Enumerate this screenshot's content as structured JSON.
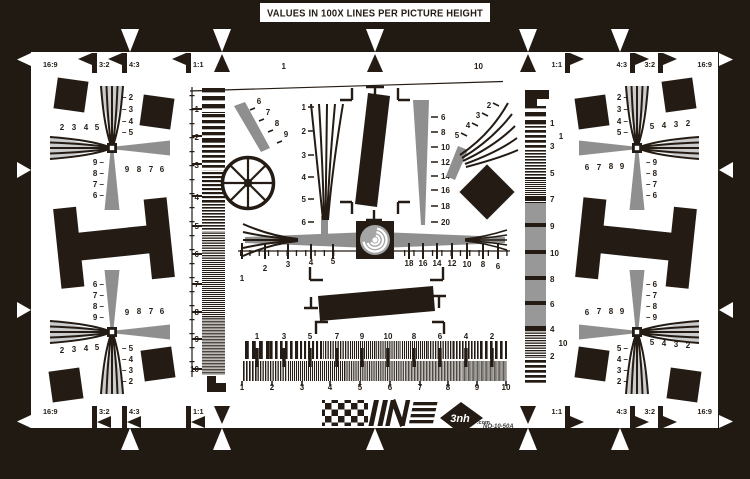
{
  "title": "VALUES IN 100X LINES PER PICTURE HEIGHT",
  "brand": {
    "logo_text": "3nh",
    "logo_domain": ".com",
    "model": "NQ-10-50A"
  },
  "aspect_markers": {
    "top_left": [
      "16:9",
      "3:2",
      "4:3",
      "1:1"
    ],
    "top_right": [
      "1:1",
      "4:3",
      "3:2",
      "16:9"
    ],
    "bottom_left": [
      "16:9",
      "3:2",
      "4:3",
      "1:1"
    ],
    "bottom_right": [
      "1:1",
      "4:3",
      "3:2",
      "16:9"
    ]
  },
  "scales": {
    "top_dash": {
      "start": "1",
      "end": "10"
    },
    "right_dash": {
      "start": "1",
      "end": "10"
    },
    "left_sweep": [
      "1",
      "2",
      "3",
      "4",
      "5",
      "6",
      "7",
      "8",
      "9",
      "10"
    ],
    "right_sweep": [
      "1",
      "3",
      "5",
      "7",
      "9",
      "10",
      "8",
      "6",
      "4",
      "2"
    ],
    "center_wedge_vertical": [
      "1",
      "2",
      "3",
      "4",
      "5",
      "6"
    ],
    "center_wedge_right": [
      "6",
      "8",
      "10",
      "12",
      "14",
      "16",
      "18",
      "20"
    ],
    "diag_wedge": [
      "6",
      "7",
      "8",
      "9"
    ],
    "fan_right": [
      "2",
      "3",
      "4",
      "5"
    ],
    "center_ruler_left": [
      "1",
      "2",
      "3",
      "4",
      "5"
    ],
    "center_ruler_right": [
      "18",
      "16",
      "14",
      "12",
      "10",
      "8",
      "6"
    ],
    "burst_row1": [
      "1",
      "3",
      "5",
      "7",
      "9",
      "10",
      "8",
      "6",
      "4",
      "2"
    ],
    "burst_row2": [
      "1",
      "2",
      "3",
      "4",
      "5",
      "6",
      "7",
      "8",
      "9",
      "10"
    ]
  },
  "crosses": {
    "top_left": {
      "v_top": [
        "2",
        "3",
        "4",
        "5"
      ],
      "h_left": [
        "2",
        "3",
        "4",
        "5"
      ],
      "h_right": [
        "9",
        "8",
        "7",
        "6"
      ],
      "v_bottom": [
        "9",
        "8",
        "7",
        "6"
      ]
    },
    "top_right": {
      "v_top": [
        "2",
        "3",
        "4",
        "5"
      ],
      "h_right": [
        "5",
        "4",
        "3",
        "2"
      ],
      "h_left": [
        "6",
        "7",
        "8",
        "9"
      ],
      "v_bottom": [
        "9",
        "8",
        "7",
        "6"
      ]
    },
    "bottom_left": {
      "v_top": [
        "6",
        "7",
        "8",
        "9"
      ],
      "h_right": [
        "9",
        "8",
        "7",
        "6"
      ],
      "h_left": [
        "2",
        "3",
        "4",
        "5"
      ],
      "v_bottom": [
        "5",
        "4",
        "3",
        "2"
      ]
    },
    "bottom_right": {
      "v_top": [
        "6",
        "7",
        "8",
        "9"
      ],
      "h_left": [
        "6",
        "7",
        "8",
        "9"
      ],
      "h_right": [
        "5",
        "4",
        "3",
        "2"
      ],
      "v_bottom": [
        "5",
        "4",
        "3",
        "2"
      ]
    }
  },
  "colors": {
    "frame": "#211a13",
    "ink": "#241c14",
    "gray": "#8f8f8f",
    "paper": "#ffffff"
  }
}
